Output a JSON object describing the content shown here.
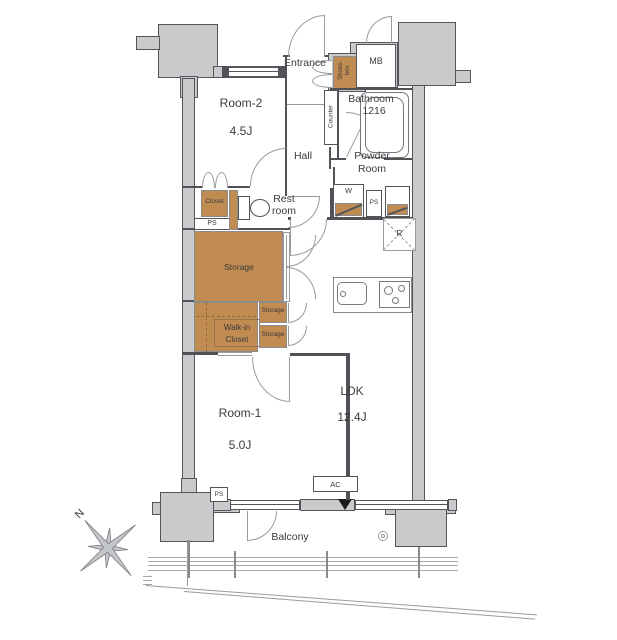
{
  "colors": {
    "storage_brown": "#c08c52",
    "wall_gray": "#c9cacb",
    "wall_outline": "#54555a",
    "marker_black": "#1b1b1b"
  },
  "rooms": {
    "room2": {
      "name": "Room-2",
      "size": "4.5J"
    },
    "room1": {
      "name": "Room-1",
      "size": "5.0J"
    },
    "ldk": {
      "name": "LDK",
      "size": "12.4J"
    },
    "bathroom": {
      "name": "Bathroom",
      "size": "1216"
    },
    "entrance": {
      "name": "Entrance"
    },
    "hall": {
      "name": "Hall"
    },
    "powder": {
      "line1": "Powder",
      "line2": "Room"
    },
    "restroom": {
      "line1": "Rest",
      "line2": "room"
    },
    "balcony": {
      "name": "Balcony"
    }
  },
  "storage": {
    "closet": "Closet",
    "walkin": {
      "line1": "Walk-in",
      "line2": "Closet"
    },
    "main": "Storage",
    "upper": "Storage",
    "lower": "Storage",
    "shoes": {
      "line1": "Shoes-",
      "line2": "box"
    }
  },
  "fixtures": {
    "mb": "MB",
    "counter": "Counter",
    "washer": "W",
    "fridge": "R",
    "ac": "AC",
    "ps": "PS",
    "north": "N"
  }
}
